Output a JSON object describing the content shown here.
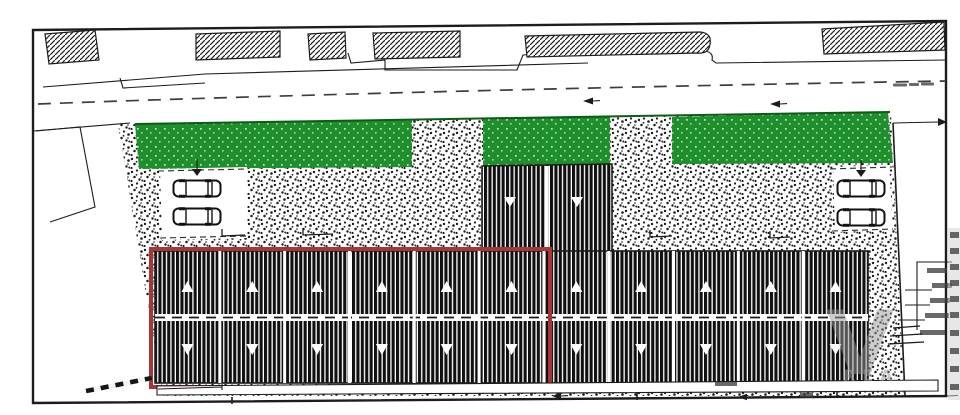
{
  "document": {
    "kind": "architectural-site-plan",
    "orientation": "landscape"
  },
  "colors": {
    "paper": "#ffffff",
    "ink": "#1c1c1c",
    "green": "#1f8f2d",
    "green_edge": "#0e5b18",
    "highlight_red": "#a8353a",
    "watermark": "#9a9a9a"
  },
  "road": {
    "centerline_style": "dashed",
    "direction_arrow_count": 2,
    "label_legible": false
  },
  "site": {
    "green_strip_count": 3,
    "paving": "stippled",
    "parking_left_cars": 2,
    "parking_right_cars": 2,
    "boundary_marker": "striped-line"
  },
  "building": {
    "rows": 2,
    "units_per_row": 11,
    "top_marker": "▲",
    "bottom_marker": "▼",
    "hatch": "vertical",
    "annex_units": 2,
    "geometry": {
      "x0": 155,
      "x1": 868,
      "y0": 251,
      "y1": 383
    }
  },
  "highlight": {
    "shape": "rectangle",
    "encloses": "left section of terraced building, both rows"
  },
  "watermark": {
    "symbol": "V",
    "caption": "REA"
  }
}
